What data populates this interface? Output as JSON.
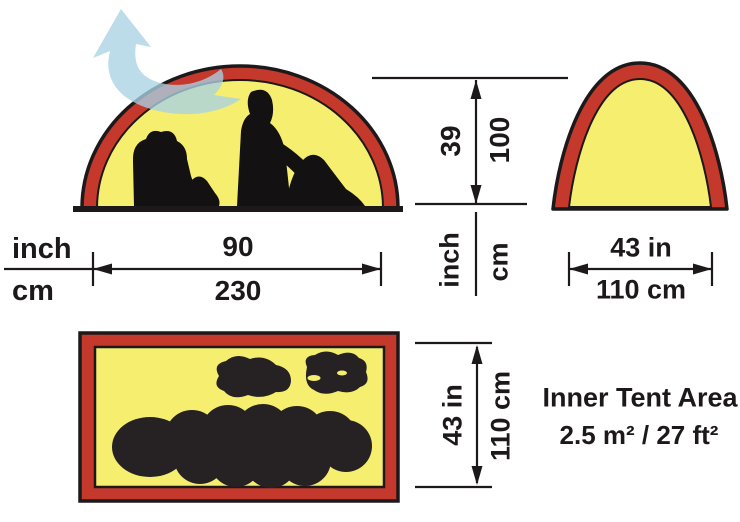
{
  "diagram_title": "Tent dimensions diagram",
  "views": {
    "side_view": "tent side profile with two seated campers and backpack silhouettes, top vent arrow",
    "front_view": "tent front profile",
    "floor_plan": "inner tent floor plan with sleeping bags and backpacks silhouettes"
  },
  "dimensions": {
    "units": {
      "inch": "inch",
      "cm": "cm"
    },
    "width": {
      "inch": "90",
      "cm": "230"
    },
    "height": {
      "inch": "39",
      "cm": "100"
    },
    "front_width": {
      "inch": "43 in",
      "cm": "110 cm"
    },
    "floor_depth": {
      "inch": "43 in",
      "cm": "110 cm"
    }
  },
  "inner_area": {
    "title": "Inner Tent Area",
    "value": "2.5 m² / 27 ft²"
  },
  "colors": {
    "tent_red": "#c4392b",
    "tent_yellow": "#f5ee6e",
    "ink": "#1d191a",
    "vent_blue": "#a9d2e4"
  }
}
